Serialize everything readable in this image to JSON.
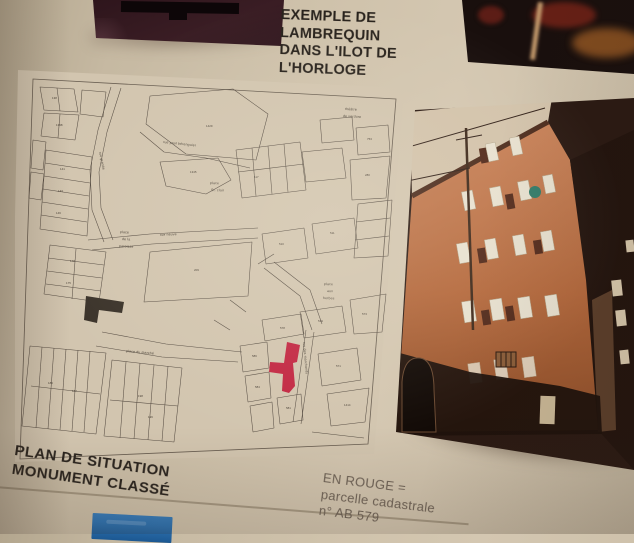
{
  "captions": {
    "top": {
      "lines": [
        "EXEMPLE DE",
        "LAMBREQUIN",
        "DANS L'ILOT DE",
        "L'HORLOGE"
      ]
    },
    "plan": {
      "lines": [
        "PLAN DE SITUATION",
        "MONUMENT CLASSÉ"
      ]
    },
    "legend": {
      "lines": [
        "EN ROUGE =",
        "parcelle cadastrale",
        "n° AB 579"
      ]
    }
  },
  "map": {
    "red_parcel": {
      "color": "#c22742"
    },
    "street_labels": [
      {
        "text": "rue grande",
        "x": 99,
        "y": 152,
        "r": 78
      },
      {
        "text": "rue paul bérenguier",
        "x": 163,
        "y": 143,
        "r": 6
      },
      {
        "text": "place",
        "x": 120,
        "y": 233,
        "r": 3
      },
      {
        "text": "de la",
        "x": 122,
        "y": 240,
        "r": 3
      },
      {
        "text": "paroisse",
        "x": 119,
        "y": 247,
        "r": 3
      },
      {
        "text": "place",
        "x": 210,
        "y": 184,
        "r": 2
      },
      {
        "text": "St. clair",
        "x": 211,
        "y": 191,
        "r": 2
      },
      {
        "text": "théâtre",
        "x": 345,
        "y": 110,
        "r": 3
      },
      {
        "text": "de verdure",
        "x": 343,
        "y": 117,
        "r": 3
      },
      {
        "text": "rue neuve",
        "x": 160,
        "y": 236,
        "r": -3
      },
      {
        "text": "place",
        "x": 324,
        "y": 285,
        "r": 2
      },
      {
        "text": "aux",
        "x": 327,
        "y": 292,
        "r": 2
      },
      {
        "text": "herbes",
        "x": 323,
        "y": 299,
        "r": 2
      },
      {
        "text": "place du marché",
        "x": 126,
        "y": 352,
        "r": 5
      },
      {
        "text": "rue des marchands",
        "x": 303,
        "y": 342,
        "r": 85
      }
    ],
    "parcel_numbers": [
      {
        "t": "138",
        "x": 52,
        "y": 99
      },
      {
        "t": "1398",
        "x": 56,
        "y": 126
      },
      {
        "t": "141",
        "x": 60,
        "y": 170
      },
      {
        "t": "143",
        "x": 58,
        "y": 192
      },
      {
        "t": "146",
        "x": 56,
        "y": 214
      },
      {
        "t": "148",
        "x": 70,
        "y": 262
      },
      {
        "t": "175",
        "x": 66,
        "y": 284
      },
      {
        "t": "1429",
        "x": 206,
        "y": 127
      },
      {
        "t": "1345",
        "x": 190,
        "y": 173
      },
      {
        "t": "117",
        "x": 254,
        "y": 178
      },
      {
        "t": "753",
        "x": 367,
        "y": 140
      },
      {
        "t": "280",
        "x": 365,
        "y": 176
      },
      {
        "t": "209",
        "x": 194,
        "y": 271
      },
      {
        "t": "510",
        "x": 279,
        "y": 245
      },
      {
        "t": "511",
        "x": 330,
        "y": 234
      },
      {
        "t": "519",
        "x": 318,
        "y": 322
      },
      {
        "t": "573",
        "x": 362,
        "y": 315
      },
      {
        "t": "578",
        "x": 280,
        "y": 329
      },
      {
        "t": "586",
        "x": 252,
        "y": 357
      },
      {
        "t": "584",
        "x": 255,
        "y": 388
      },
      {
        "t": "581",
        "x": 286,
        "y": 409
      },
      {
        "t": "571",
        "x": 336,
        "y": 367
      },
      {
        "t": "1414",
        "x": 344,
        "y": 406
      },
      {
        "t": "186",
        "x": 48,
        "y": 384
      },
      {
        "t": "187",
        "x": 72,
        "y": 392
      },
      {
        "t": "198",
        "x": 138,
        "y": 397
      },
      {
        "t": "196",
        "x": 148,
        "y": 418
      }
    ]
  },
  "colors": {
    "board": "#c9bca6",
    "map_paper": "#d2c5af",
    "map_ink": "#584e44",
    "red": "#c22742",
    "blue_card": "#2e72b0",
    "caption_ink": "#29231d",
    "legend_ink": "#6e6256"
  }
}
